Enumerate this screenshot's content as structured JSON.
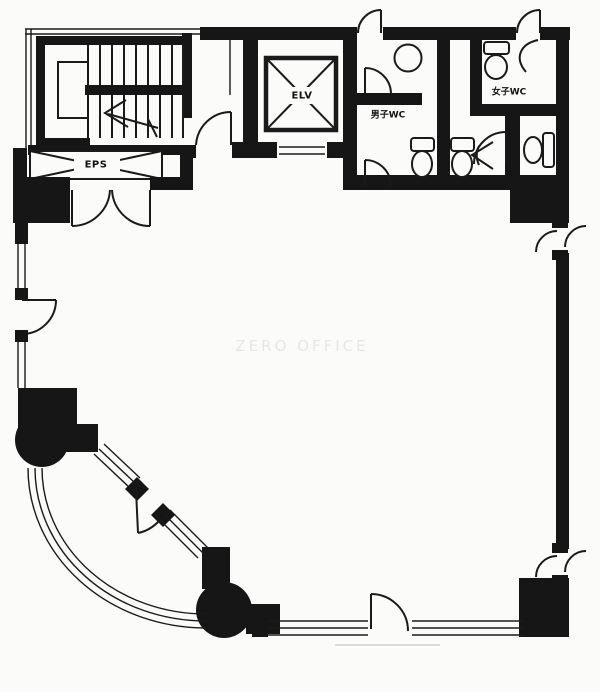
{
  "floorplan": {
    "watermark": "ZERO OFFICE",
    "labels": {
      "stair_shaft": "EPS",
      "elevator": "ELV",
      "mens_wc": "男子WC",
      "womens_wc": "女子WC"
    },
    "colors": {
      "wall": "#161616",
      "line": "#1a1a1a",
      "background": "#fbfbfa",
      "watermark": "#e7e7e7",
      "smudge": "#dadada"
    }
  }
}
